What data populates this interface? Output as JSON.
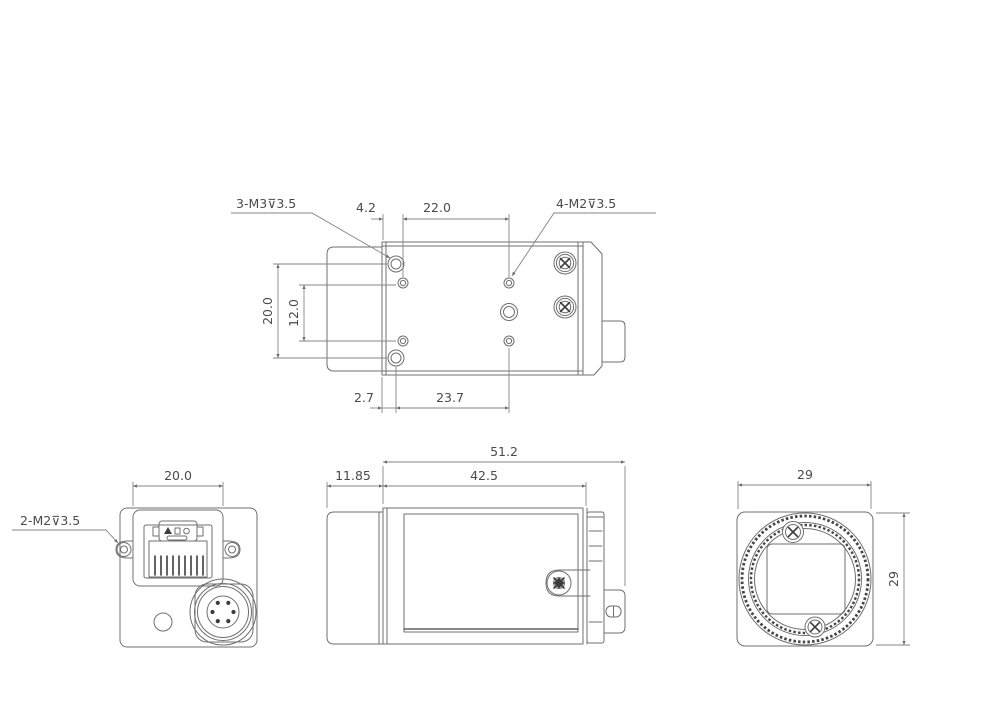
{
  "drawing": {
    "top_view": {
      "thread_label_left": "3-M3⊽3.5",
      "thread_label_right": "4-M2⊽3.5",
      "dim_edge_to_hole": "4.2",
      "dim_hole_span": "22.0",
      "dim_height_outer": "20.0",
      "dim_height_inner": "12.0",
      "dim_bottom_edge": "2.7",
      "dim_bottom_span": "23.7"
    },
    "rear_view": {
      "dim_connector_width": "20.0",
      "thread_label": "2-M2⊽3.5"
    },
    "side_view": {
      "dim_total_length": "51.2",
      "dim_front_section": "11.85",
      "dim_body_length": "42.5"
    },
    "front_view": {
      "dim_width": "29",
      "dim_height": "29"
    }
  },
  "colors": {
    "background": "#ffffff",
    "line": "#6f6f6f",
    "line_dark": "#3d3d3d",
    "text": "#4b4b4b"
  }
}
